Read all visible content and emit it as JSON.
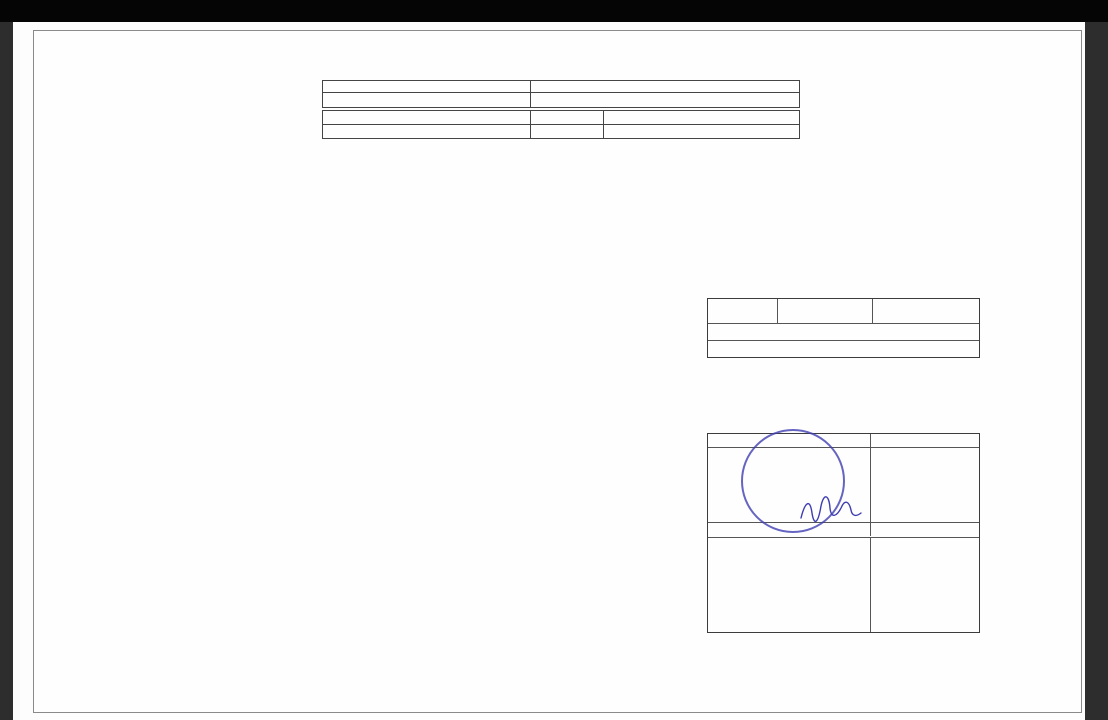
{
  "page": {
    "anexa": "ANEXA NR.18",
    "title": "RELEVEU - C7 - SUBSOL",
    "scale": "SCARA 1:100"
  },
  "info_table": {
    "nr_cadastral_label": "Nr.Cadastral al terenului",
    "adresa_label": "Adresa imobilului",
    "nr_cadastral_value": "111992",
    "adresa_value": "Jud.Constanta, Loc.Mamaia-Sat, Str.M6, nr.1, Lot 2",
    "carte_funciara_label": "Carte Funciara colectiva nr.",
    "uat_label": "UAT",
    "uat_value": "NAVODARI",
    "cod_unitate_label": "Cod unitate individuala (UI)",
    "cf_label": "CF individuala"
  },
  "rooms_table": {
    "headers": [
      [
        "Nr.",
        "incapere"
      ],
      [
        "Denumire",
        "incapere"
      ],
      [
        "Suprafata",
        "utila [mp]"
      ]
    ],
    "rows": [
      {
        "nr": "1",
        "name": "ATELIER",
        "area": "65.1"
      },
      {
        "nr": "2",
        "name": "DEPOZITARE",
        "area": "13.5"
      },
      {
        "nr": "3",
        "name": "DEPOZITARE",
        "area": "17.1"
      },
      {
        "nr": "4",
        "name": "DEPOZITARE",
        "area": "6.4"
      },
      {
        "nr": "5",
        "name": "DEPOZITARE",
        "area": "10.4"
      },
      {
        "nr": "6",
        "name": "HOL",
        "area": "32.8"
      }
    ],
    "subtotal": "Suprafata utila = 145.3 mp",
    "row7": {
      "nr": "7",
      "name": "CASA SCARII",
      "area": "4.6"
    },
    "total": "Suprafata utila = 149.9 mp"
  },
  "signature_table": {
    "executant_label": "Executant",
    "data_label": "Data",
    "executant_line1": "PFA NECULAE EVA",
    "executant_line2": "Aut.Seria RO-CT-F.Nr.0168",
    "executant_line3": "Categoria B",
    "date_value": "24.10.2025",
    "receptionat_label": "Receptionat",
    "data_label2": "Data",
    "nume_label": "Nume, prenume, semnatura, stampila",
    "stamp": {
      "rim_text": "Persoana fizica autorizata de A.N.C.P.I.",
      "line0": "AUTORIZARE",
      "line1": "Seria RO-CT-F.",
      "line2": "Nr. 0168/04.07.2023",
      "line3": "NECULAE EVA",
      "color": "#3e3eb2"
    }
  },
  "plan": {
    "chepeng": "chepeng",
    "rooms": [
      {
        "n": "1",
        "x": 480,
        "y": 539
      },
      {
        "n": "2",
        "x": 226,
        "y": 568
      },
      {
        "n": "3",
        "x": 208,
        "y": 490
      },
      {
        "n": "4",
        "x": 498,
        "y": 353
      },
      {
        "n": "5",
        "x": 498,
        "y": 295
      },
      {
        "n": "6",
        "x": 418,
        "y": 420
      },
      {
        "n": "7",
        "x": 573,
        "y": 403
      }
    ],
    "dims": [
      {
        "t": "1.92",
        "x": 406,
        "y": 231,
        "r": 0
      },
      {
        "t": "3.53",
        "x": 520,
        "y": 264,
        "r": 0
      },
      {
        "t": "2.71",
        "x": 541,
        "y": 296,
        "r": -90
      },
      {
        "t": "1.49",
        "x": 454,
        "y": 304,
        "r": -90
      },
      {
        "t": "4.09",
        "x": 505,
        "y": 320,
        "r": 0
      },
      {
        "t": "4.08",
        "x": 502,
        "y": 339,
        "r": 0
      },
      {
        "t": "1.58",
        "x": 544,
        "y": 352,
        "r": -90
      },
      {
        "t": "1.92",
        "x": 418,
        "y": 277,
        "r": 0
      },
      {
        "t": "11.57",
        "x": 431,
        "y": 372,
        "r": -90
      },
      {
        "t": "1.50",
        "x": 420,
        "y": 389,
        "r": 0
      },
      {
        "t": "5.62",
        "x": 450,
        "y": 447,
        "r": -90
      },
      {
        "t": "4.33",
        "x": 489,
        "y": 413,
        "r": 0
      },
      {
        "t": "2.38",
        "x": 564,
        "y": 388,
        "r": 0
      },
      {
        "t": "1.33",
        "x": 531,
        "y": 397,
        "r": -90
      },
      {
        "t": "2.69",
        "x": 587,
        "y": 417,
        "r": -90
      },
      {
        "t": "3.49",
        "x": 549,
        "y": 486,
        "r": 0
      },
      {
        "t": "8.95",
        "x": 509,
        "y": 539,
        "r": -90
      },
      {
        "t": "6.07",
        "x": 584,
        "y": 528,
        "r": -90
      },
      {
        "t": "11.44",
        "x": 448,
        "y": 592,
        "r": 0
      },
      {
        "t": "4.50",
        "x": 212,
        "y": 443,
        "r": 0
      },
      {
        "t": "4.48",
        "x": 333,
        "y": 443,
        "r": 0
      },
      {
        "t": "2.94",
        "x": 307,
        "y": 473,
        "r": -90
      },
      {
        "t": "1.92",
        "x": 383,
        "y": 462,
        "r": -90
      },
      {
        "t": "3.81",
        "x": 160,
        "y": 490,
        "r": -90
      },
      {
        "t": "3.82",
        "x": 284,
        "y": 490,
        "r": -90
      },
      {
        "t": "5.57",
        "x": 370,
        "y": 508,
        "r": 0
      },
      {
        "t": "5.55",
        "x": 373,
        "y": 526,
        "r": 0
      },
      {
        "t": "2.42",
        "x": 160,
        "y": 570,
        "r": -90
      },
      {
        "t": "3.33",
        "x": 316,
        "y": 562,
        "r": -90
      },
      {
        "t": "5.59",
        "x": 226,
        "y": 590,
        "r": 0
      }
    ]
  }
}
